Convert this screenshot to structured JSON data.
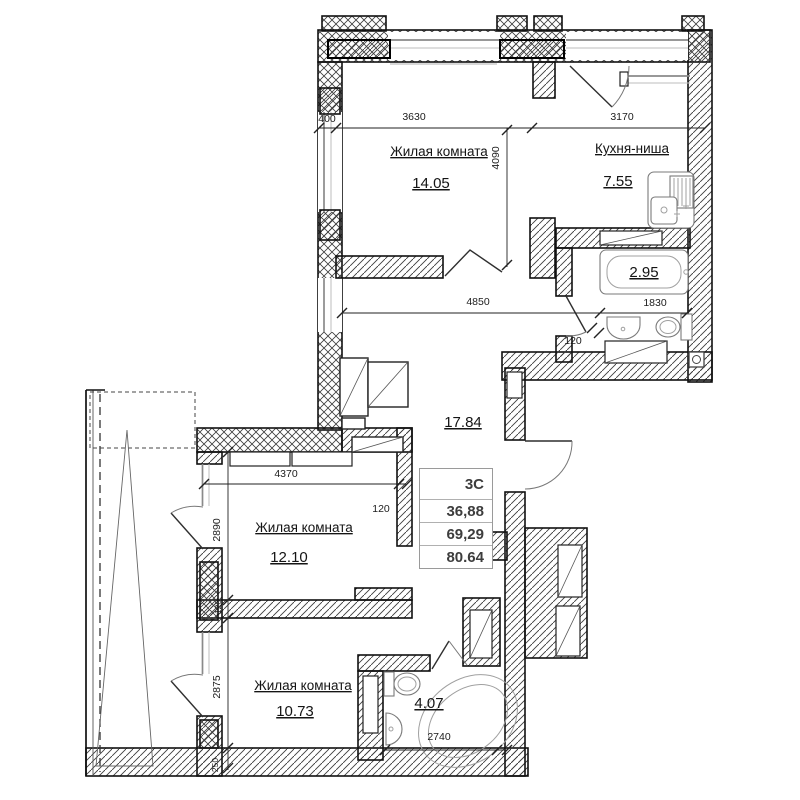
{
  "info_table": {
    "type": "3С",
    "living_area": "36,88",
    "total_area": "69,29",
    "total_with_summer": "80.64"
  },
  "rooms": {
    "living1": {
      "name": "Жилая комната",
      "area": "14.05"
    },
    "kitchen": {
      "name": "Кухня-ниша",
      "area": "7.55"
    },
    "bath1": {
      "area": "2.95"
    },
    "hall": {
      "area": "17.84"
    },
    "living2": {
      "name": "Жилая комната",
      "area": "12.10"
    },
    "living3": {
      "name": "Жилая комната",
      "area": "10.73"
    },
    "bath2": {
      "area": "4.07"
    }
  },
  "dimensions": {
    "d400": "400",
    "d3630": "3630",
    "d3170": "3170",
    "d4090": "4090",
    "d4850": "4850",
    "d1830": "1830",
    "d120_bath": "120",
    "d4370": "4370",
    "d2890": "2890",
    "d120_room2": "120",
    "d120_wall": "120",
    "d2875": "2875",
    "d2740": "2740",
    "d250": "250"
  },
  "colors": {
    "wall_line": "#111111",
    "hatch": "#3c3c3c",
    "dim_text": "#1c1c1c"
  }
}
